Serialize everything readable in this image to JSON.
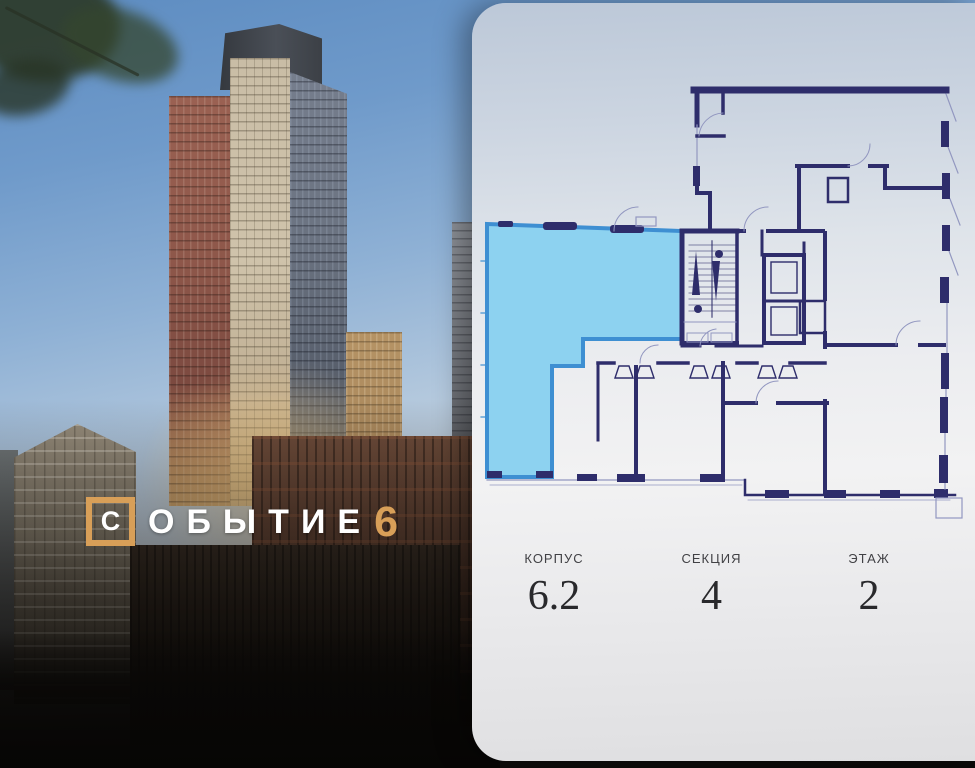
{
  "brand": {
    "boxed_letter": "С",
    "name_rest": "ОБЫТИЕ",
    "number": "6"
  },
  "apartment_info": {
    "items": [
      {
        "label": "КОРПУС",
        "value": "6.2"
      },
      {
        "label": "СЕКЦИЯ",
        "value": "4"
      },
      {
        "label": "ЭТАЖ",
        "value": "2"
      }
    ]
  },
  "floor_plan": {
    "highlighted_unit": "selected-apartment",
    "features": [
      "stairs",
      "elevator",
      "elevator"
    ]
  },
  "colors": {
    "accent": "#d89f58",
    "wall": "#2e2d6b",
    "thin": "#9297c0",
    "highlight-fill": "#8dd2f0",
    "highlight-stroke": "#3e8fd2"
  }
}
